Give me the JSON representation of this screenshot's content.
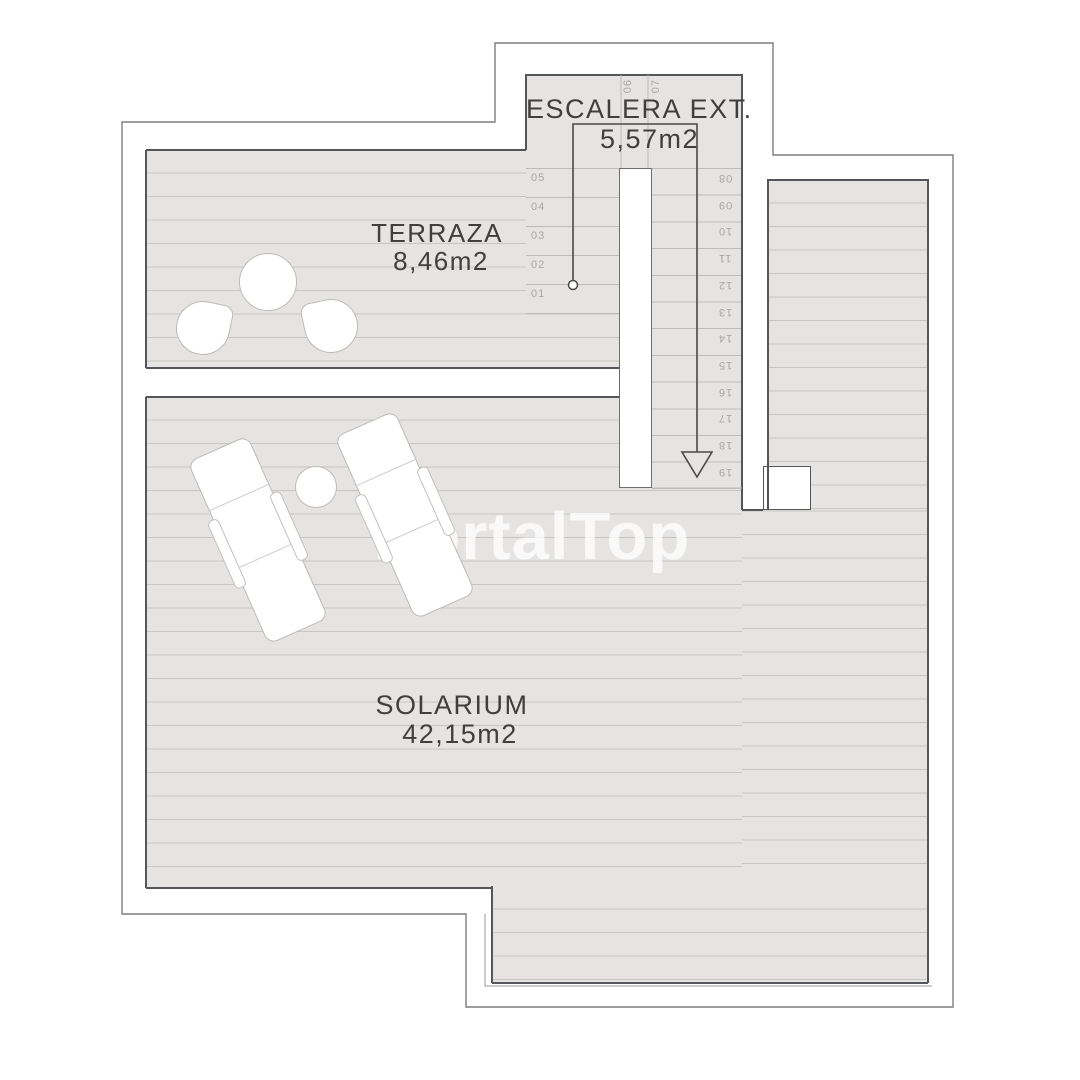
{
  "plan": {
    "rooms": {
      "escalera": {
        "name": "ESCALERA EXT.",
        "area": "5,57m2"
      },
      "terraza": {
        "name": "TERRAZA",
        "area": "8,46m2"
      },
      "solarium": {
        "name": "SOLARIUM",
        "area": "42,15m2"
      }
    },
    "stairs": {
      "left_steps": [
        "05",
        "04",
        "03",
        "02",
        "01"
      ],
      "top_steps": [
        "06",
        "07"
      ],
      "right_steps": [
        "08",
        "09",
        "10",
        "11",
        "12",
        "13",
        "14",
        "15",
        "16",
        "17",
        "18",
        "19"
      ]
    },
    "watermark": "PortalTop",
    "colors": {
      "deck_fill": "#e5e4e2",
      "board_line": "#c7c6c3",
      "deck_border": "#55565a",
      "outer_line": "#7d7d7b",
      "label_text": "#3f3f3f",
      "step_text": "#a7a7a5"
    }
  }
}
